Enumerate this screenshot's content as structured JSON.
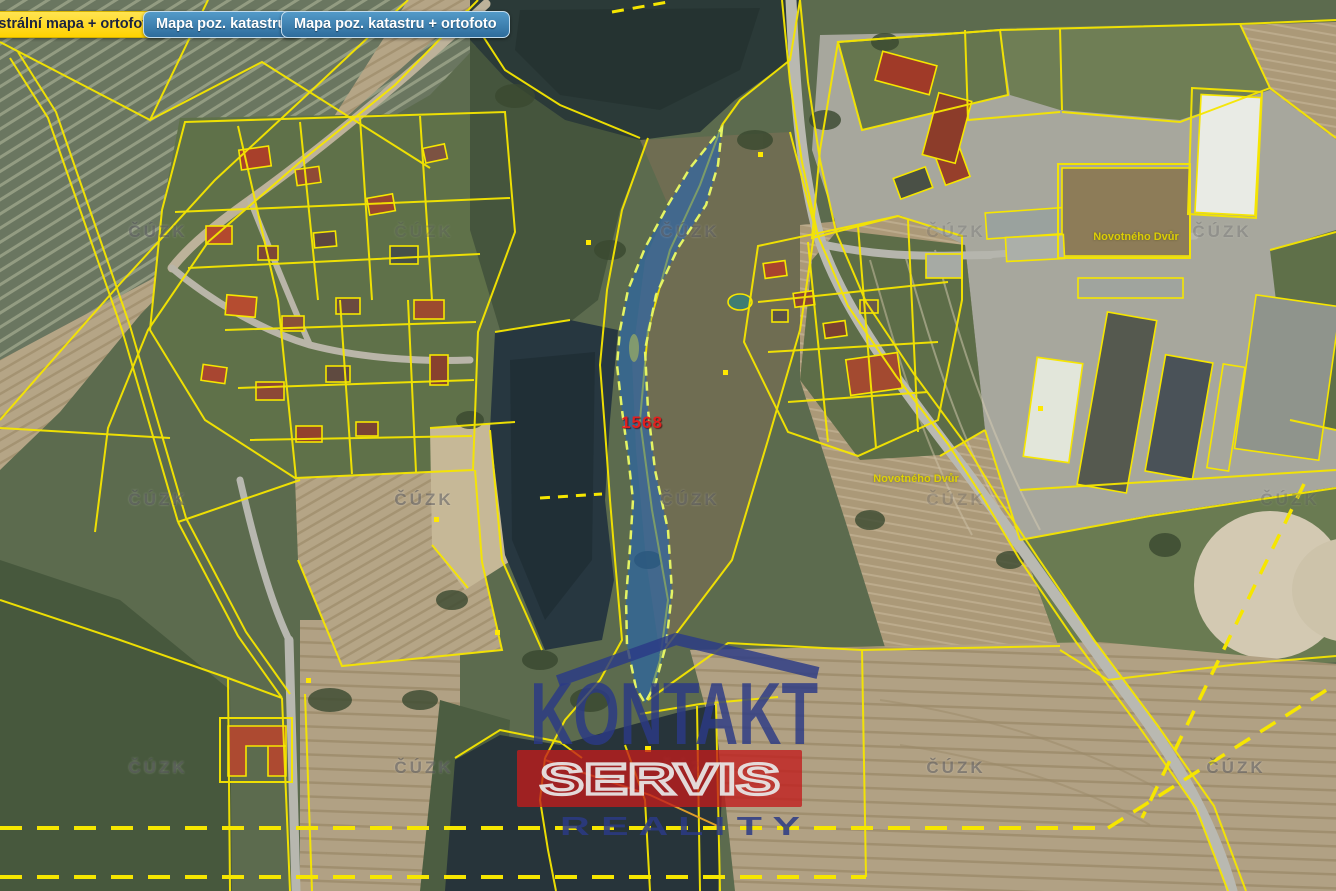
{
  "toolbar": {
    "buttons": [
      {
        "label": "Katastrální mapa + ortofoto",
        "active": true
      },
      {
        "label": "Mapa poz. katastru",
        "active": false
      },
      {
        "label": "Mapa poz. katastru + ortofoto",
        "active": false
      }
    ],
    "active_color": "#ffd200",
    "inactive_color": "#2e6c9c"
  },
  "map": {
    "type": "cadastral map + orthophoto",
    "parcel_number": "1568",
    "parcel_number_color": "#e21f1f",
    "highlight_fill": "#1e64be",
    "cadastral_line_color": "#f6e600",
    "cuzk_watermark": "ČÚZK",
    "place_labels": [
      {
        "text": "Novotného Dvůr"
      },
      {
        "text": "Novotného Dvůr"
      }
    ]
  },
  "watermark": {
    "line1": "KONTAKT",
    "line2": "SERVIS",
    "line3": "R E A L I T Y",
    "banner_color": "#c21c1c",
    "text_color": "#2b3a86"
  }
}
